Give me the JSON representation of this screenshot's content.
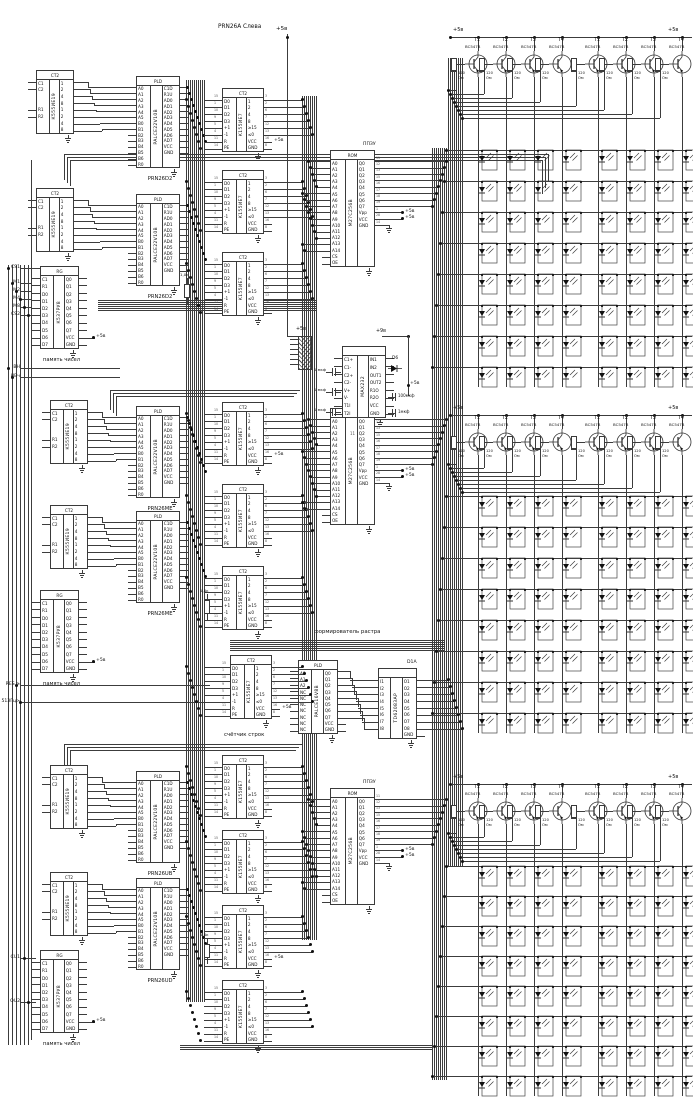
{
  "title": "PRN26A Слева",
  "power": {
    "v5": "+5в",
    "v9": "+9в"
  },
  "left_signals": [
    "CS1",
    "M1",
    "M2",
    "M4",
    "M8",
    "CS2",
    "ВН",
    "НВч",
    "RES ≥",
    "513Гц>",
    "CU1",
    "OU2"
  ],
  "section_labels": {
    "ram": "память чисел",
    "row_counter": "счётчик строк",
    "raster_former": "формирователь растра"
  },
  "pal_designators": [
    "PRN26D2",
    "PRN26D2",
    "PRN26ME",
    "PRN26ME",
    "PRN26UB",
    "PRN26UD"
  ],
  "eprom_designator": "ППЗУ",
  "driver_designator": "D1A",
  "chips": {
    "counter_ie19": {
      "name": "К555ИЕ19",
      "header": "CT2",
      "left": [
        "C1",
        "C2",
        "",
        "",
        "R1",
        "R2",
        "",
        ""
      ],
      "right": [
        "1",
        "2",
        "4",
        "8",
        "1",
        "2",
        "4",
        "8"
      ]
    },
    "counter_ie7": {
      "name": "К155ИЕ7",
      "header": "CT2",
      "left": [
        "D0",
        "D1",
        "D2",
        "D3",
        "+1",
        "-1",
        "R",
        "PE"
      ],
      "left_n": [
        "15",
        "1",
        "10",
        "9",
        "5",
        "4",
        "11",
        "14"
      ],
      "right": [
        "1",
        "2",
        "4",
        "8",
        "≥15",
        "≤0",
        "VCC",
        "GND"
      ],
      "right_n": [
        "3",
        "2",
        "6",
        "7",
        "12",
        "13",
        "16",
        "8"
      ]
    },
    "pal22": {
      "name": "PALCE22V10B",
      "header": "PLD",
      "left": [
        "A0",
        "A1",
        "A2",
        "A3",
        "A4",
        "A5",
        "B0",
        "B1",
        "B2",
        "B3",
        "B4",
        "B5",
        "B6",
        "R0"
      ],
      "right": [
        "C1D",
        "R1U",
        "AD0",
        "AD1",
        "AD2",
        "AD3",
        "AD4",
        "AD5",
        "AD6",
        "AD7",
        "VCC",
        "GND"
      ]
    },
    "ram": {
      "name": "К537РУ8",
      "header": "RG",
      "left": [
        "C1",
        "R1",
        "D0",
        "D1",
        "D2",
        "D3",
        "D4",
        "D5",
        "D6",
        "D7"
      ],
      "right": [
        "Q0",
        "Q1",
        "Q2",
        "Q3",
        "Q4",
        "Q5",
        "Q6",
        "Q7",
        "VCC",
        "GND"
      ]
    },
    "eprom": {
      "name": "М27С256В",
      "header": "ROM",
      "left": [
        "A0",
        "A1",
        "A2",
        "A3",
        "A4",
        "A5",
        "A6",
        "A7",
        "A8",
        "A9",
        "A10",
        "A11",
        "A12",
        "A13",
        "A14",
        "CS",
        "OE"
      ],
      "right": [
        "Q0",
        "Q1",
        "Q2",
        "Q3",
        "Q4",
        "Q5",
        "Q6",
        "Q7",
        "Vpp",
        "VCC",
        "GND"
      ],
      "right_n": [
        "11",
        "12",
        "13",
        "15",
        "16",
        "17",
        "18",
        "19",
        "1",
        "28",
        "14"
      ]
    },
    "max232": {
      "name": "MAX232",
      "header": "",
      "left": [
        "C1+",
        "C1-",
        "C2+",
        "C2-",
        "V+",
        "V-",
        "T1I",
        "T2I"
      ],
      "right": [
        "IN1",
        "IN2",
        "OUT1",
        "OUT2",
        "R1O",
        "R2O",
        "VCC",
        "GND"
      ]
    },
    "pal16": {
      "name": "PALCE16V8B",
      "header": "PLD",
      "left": [
        "A0",
        "A1",
        "A2",
        "NC",
        "NC",
        "NC",
        "NC",
        "NC",
        "NC",
        "NC"
      ],
      "right": [
        "Q0",
        "Q1",
        "Q2",
        "Q3",
        "Q4",
        "Q5",
        "Q6",
        "Q7",
        "VCC",
        "GND"
      ]
    },
    "td62083": {
      "name": "TD62083AP",
      "header": "",
      "left": [
        "I1",
        "I2",
        "I3",
        "I4",
        "I5",
        "I6",
        "I7",
        "I8"
      ],
      "right": [
        "O1",
        "O2",
        "O3",
        "O4",
        "O5",
        "O6",
        "O7",
        "O8",
        "GND"
      ]
    }
  },
  "transistors": {
    "labels": [
      "T1",
      "T2",
      "T3",
      "T4",
      "T1",
      "T2",
      "T3",
      "T4"
    ],
    "part": "BC547B",
    "base_resistor": "120",
    "base_resistor_unit": "Ом"
  },
  "matrix": {
    "groups": 3,
    "cols": 8,
    "rows": 8
  },
  "misc": {
    "diode": "D6",
    "cap_small": "1 мкф",
    "cap_100": "100мкф",
    "cap_1": "1мкф",
    "res_1k": "1,0к",
    "pin11": "11"
  }
}
